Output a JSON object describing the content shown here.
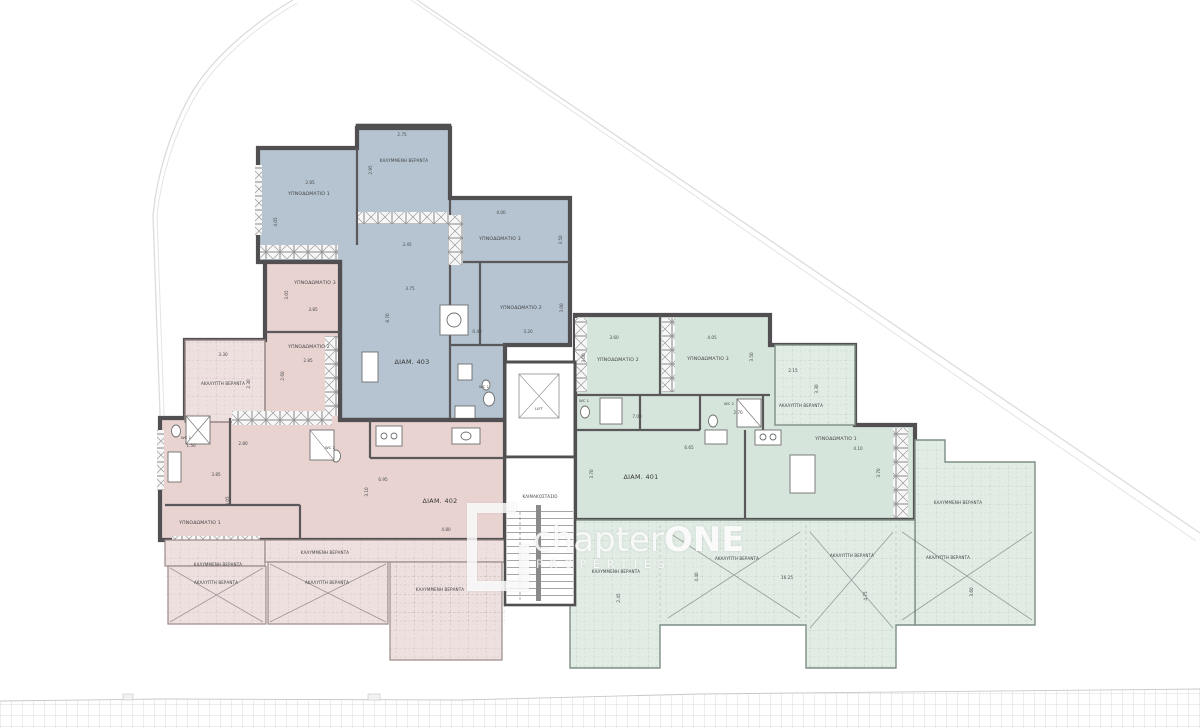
{
  "watermark": {
    "brand": "chapter",
    "brand_accent": "ONE",
    "subtitle": "PROPERTIES"
  },
  "common": {
    "lift": "LIFT",
    "staircase": "ΚΛΙΜΑΚΟΣΤΑΣΙΟ"
  },
  "colors": {
    "blue": "#b5c4d0",
    "blue_veranda": "#cfdbe3",
    "pink": "#e8d3d1",
    "pink_veranda": "#eee0de",
    "green": "#d6e5db",
    "green_veranda": "#e0ece4",
    "wall": "#514f52"
  },
  "apartments": [
    {
      "id": "403",
      "name": "ΔΙΑΜ. 403",
      "rooms": [
        "ΥΠΝΟΔΩΜΑΤΙΟ 1",
        "ΥΠΝΟΔΩΜΑΤΙΟ 3",
        "ΥΠΝΟΔΩΜΑΤΙΟ 2",
        "ΚΑΛΥΜΜΕΝΗ ΒΕΡΑΝΤΑ",
        "WC 1"
      ],
      "dims": [
        "2.75",
        "2.95",
        "2.85",
        "4.05",
        "4.00",
        "3.50",
        "3.45",
        "3.75",
        "8.70",
        "0.40",
        "3.20",
        "3.00"
      ]
    },
    {
      "id": "402",
      "name": "ΔΙΑΜ. 402",
      "rooms": [
        "ΥΠΝΟΔΩΜΑΤΙΟ 3",
        "ΥΠΝΟΔΩΜΑΤΙΟ 2",
        "ΥΠΝΟΔΩΜΑΤΙΟ 1",
        "ΑΚΑΛΥΠΤΗ ΒΕΡΑΝΤΑ",
        "ΚΑΛΥΜΜΕΝΗ ΒΕΡΑΝΤΑ",
        "ΚΑΛΥΜΜΕΝΗ ΒΕΡΑΝΤΑ",
        "ΑΚΑΛΥΠΤΗ ΒΕΡΑΝΤΑ",
        "ΑΚΑΛΥΠΤΗ ΒΕΡΑΝΤΑ",
        "ΚΑΛΥΜΜΕΝΗ ΒΕΡΑΝΤΑ",
        "WC 1",
        "WC 2"
      ],
      "dims": [
        "3.30",
        "2.30",
        "3.85",
        "3.05",
        "2.85",
        "2.60",
        "2.80",
        "1.50",
        "3.85",
        "3.05",
        "6.95",
        "3.10",
        "4.80"
      ]
    },
    {
      "id": "401",
      "name": "ΔΙΑΜ. 401",
      "rooms": [
        "ΥΠΝΟΔΩΜΑΤΙΟ 2",
        "ΥΠΝΟΔΩΜΑΤΙΟ 3",
        "ΥΠΝΟΔΩΜΑΤΙΟ 1",
        "ΑΚΑΛΥΠΤΗ ΒΕΡΑΝΤΑ",
        "ΚΑΛΥΜΜΕΝΗ ΒΕΡΑΝΤΑ",
        "ΚΑΛΥΜΜΕΝΗ ΒΕΡΑΝΤΑ",
        "ΑΚΑΛΥΠΤΗ ΒΕΡΑΝΤΑ",
        "ΑΚΑΛΥΠΤΗ ΒΕΡΑΝΤΑ",
        "ΑΚΑΛΥΠΤΗ ΒΕΡΑΝΤΑ",
        "WC 1",
        "WC 2"
      ],
      "dims": [
        "3.60",
        "4.05",
        "3.00",
        "3.50",
        "2.15",
        "3.30",
        "6.65",
        "3.70",
        "4.10",
        "3.70",
        "7.00",
        "2.70",
        "4.40",
        "16.25",
        "4.75",
        "3.60",
        "2.45"
      ]
    }
  ]
}
